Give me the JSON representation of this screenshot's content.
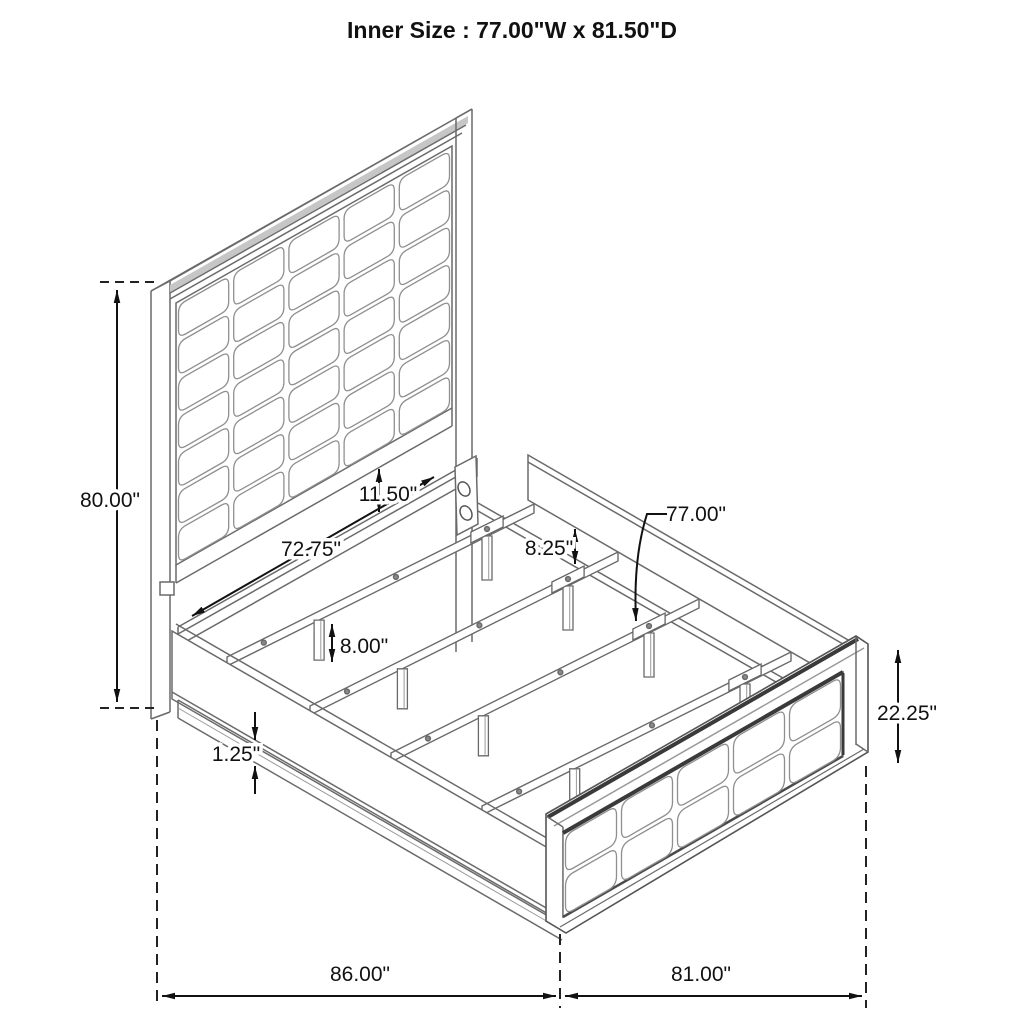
{
  "title": "Inner Size : 77.00\"W x 81.50\"D",
  "diagram": {
    "type": "isometric bed frame dimension drawing",
    "dimensions": {
      "headboard_height": "80.00\"",
      "slat_frame_width": "72.75\"",
      "headboard_clearance": "11.50\"",
      "rail_above_slats": "8.25\"",
      "slat_length": "77.00\"",
      "leg_height": "8.00\"",
      "rail_lip_thickness": "1.25\"",
      "footboard_height": "22.25\"",
      "overall_depth": "86.00\"",
      "overall_width": "81.00\""
    }
  }
}
